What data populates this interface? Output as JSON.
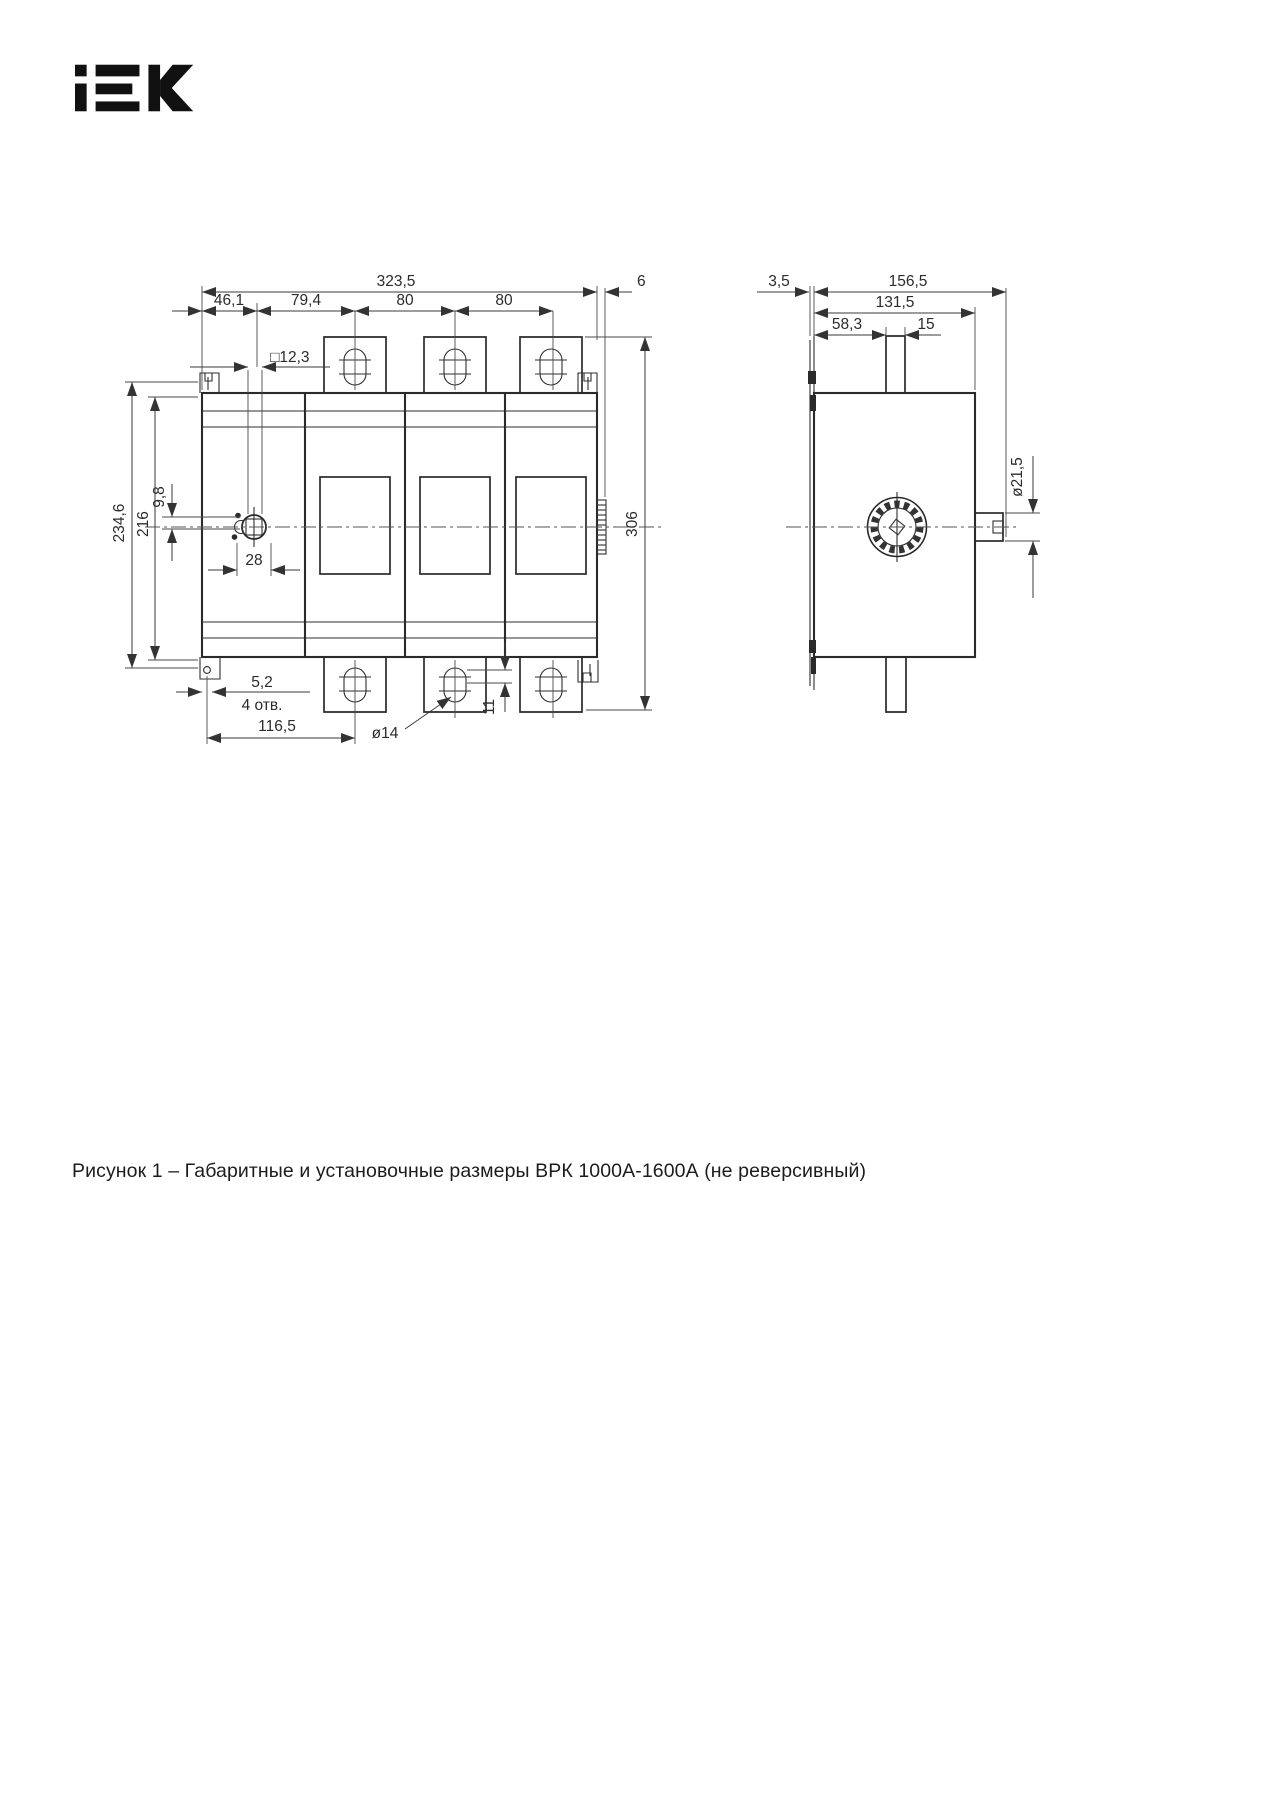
{
  "brand": {
    "logo_label": "IEK"
  },
  "caption": "Рисунок 1 – Габаритные и установочные размеры ВРК 1000А-1600А (не реверсивный)",
  "front_view": {
    "dims": {
      "total_width": "323,5",
      "seg_46_1": "46,1",
      "seg_79_4": "79,4",
      "seg_80a": "80",
      "seg_80b": "80",
      "square_hole": "□12,3",
      "offset_9_8": "9,8",
      "height_216": "216",
      "height_234_6": "234,6",
      "width_28": "28",
      "hole_5_2": "5,2",
      "holes_count": "4 отв.",
      "dist_116_5": "116,5",
      "slot_dia_14": "ø14",
      "offset_11": "11",
      "gap_6": "6",
      "total_height_306": "306"
    }
  },
  "side_view": {
    "dims": {
      "plate_3_5": "3,5",
      "total_depth_156_5": "156,5",
      "body_depth_131_5": "131,5",
      "offset_58_3": "58,3",
      "shaft_15": "15",
      "shaft_dia_21_5": "ø21,5"
    }
  }
}
